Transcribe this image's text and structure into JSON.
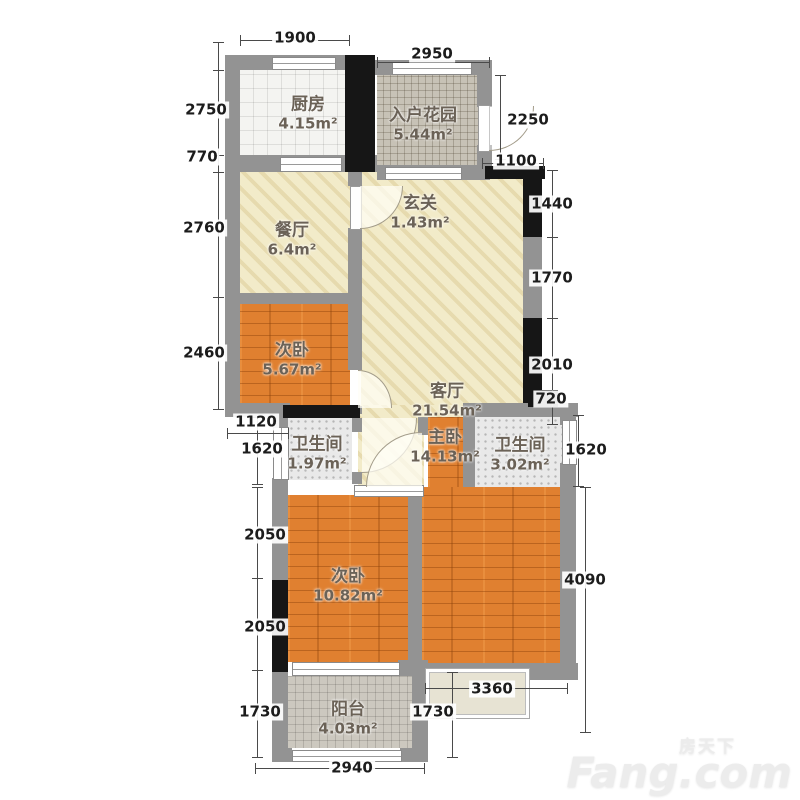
{
  "rooms": [
    {
      "name": "厨房",
      "area": "4.15m²"
    },
    {
      "name": "入户花园",
      "area": "5.44m²"
    },
    {
      "name": "餐厅",
      "area": "6.4m²"
    },
    {
      "name": "玄关",
      "area": "1.43m²"
    },
    {
      "name": "次卧",
      "area": "5.67m²"
    },
    {
      "name": "客厅",
      "area": "21.54m²"
    },
    {
      "name": "卫生间",
      "area": "1.97m²"
    },
    {
      "name": "主卧",
      "area": "14.13m²"
    },
    {
      "name": "卫生间",
      "area": "3.02m²"
    },
    {
      "name": "次卧",
      "area": "10.82m²"
    },
    {
      "name": "阳台",
      "area": "4.03m²"
    }
  ],
  "dims": {
    "top": [
      "1900",
      "2950"
    ],
    "left": [
      "2750",
      "770",
      "2760",
      "2460",
      "1120",
      "1620",
      "2050",
      "2050",
      "1730"
    ],
    "right": [
      "2250",
      "1100",
      "1440",
      "1770",
      "2010",
      "720",
      "1620",
      "4090"
    ],
    "bottom": [
      "3360",
      "1730",
      "2940"
    ]
  },
  "watermark": {
    "cn": "房天下",
    "en": "Fang.com"
  }
}
